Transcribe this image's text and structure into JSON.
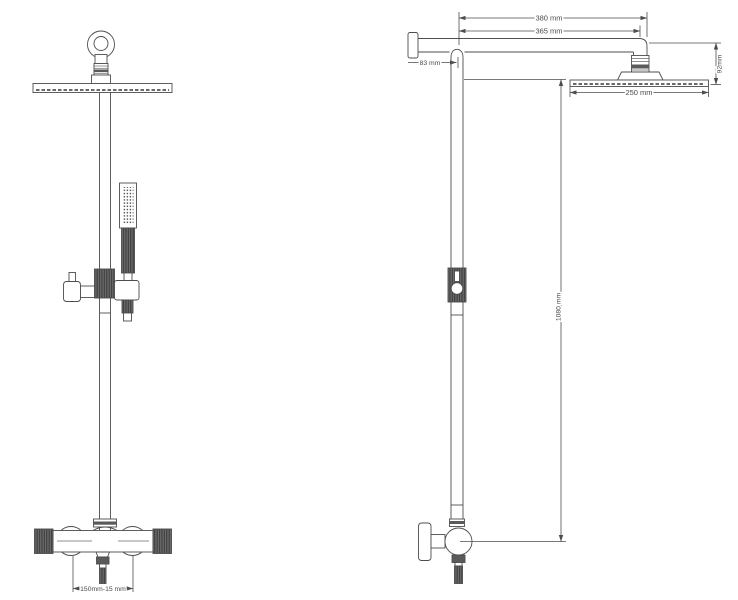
{
  "drawing": {
    "type": "technical-drawing",
    "subject": "shower-column-two-views",
    "colors": {
      "background": "#ffffff",
      "line": "#4d4d4d",
      "dark_fill": "#5a5a5a",
      "text": "#4a4a4a"
    },
    "dimensions": {
      "arm_reach_overall": "380 mm",
      "arm_reach_to_head": "365 mm",
      "wall_to_riser": "83 mm",
      "head_drop_height": "92mm",
      "head_width": "250 mm",
      "riser_height": "1080 mm",
      "valve_inlet_centres": "150mm-15 mm"
    }
  }
}
